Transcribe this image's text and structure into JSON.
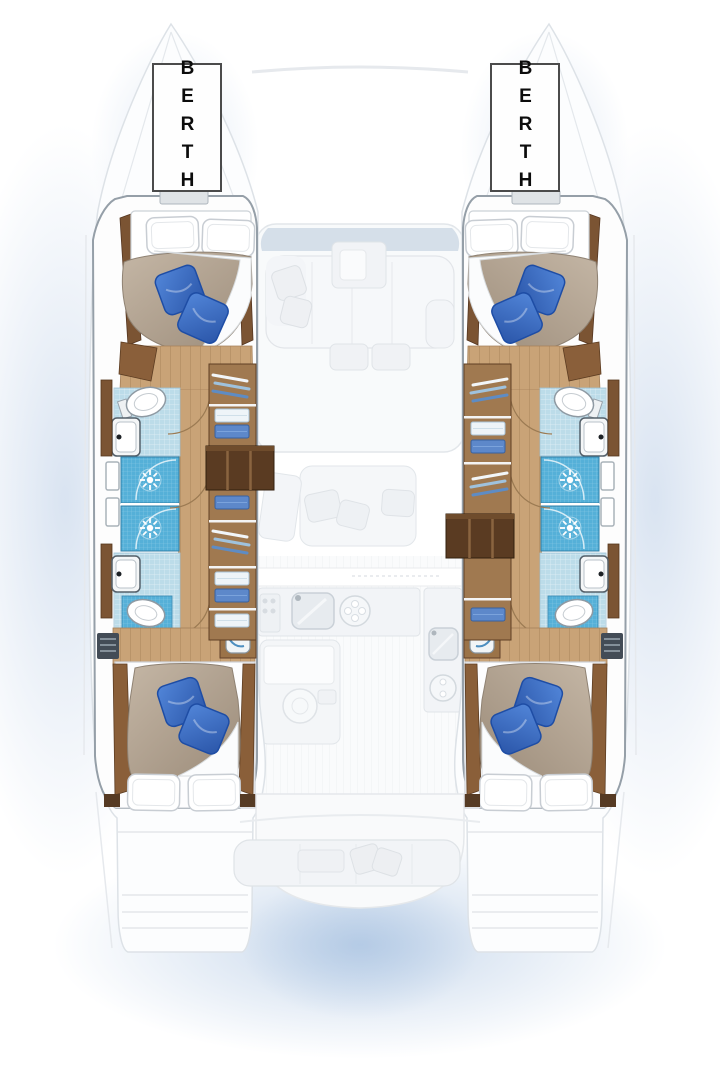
{
  "labels": {
    "berth_port": "BERTH",
    "berth_starboard": "BERTH"
  },
  "floorplan": {
    "type": "catamaran-interior-deck-plan",
    "highlighted_areas": [
      "port-forward-berth",
      "starboard-forward-berth",
      "port-aft-berth",
      "starboard-aft-berth",
      "port-heads-with-shower-stalls",
      "starboard-heads-with-shower-stalls",
      "wardrobe-shelving",
      "companionway-steps",
      "vanity-sinks",
      "toilets"
    ],
    "ghosted_areas": [
      "saloon",
      "galley",
      "cockpit",
      "swim-platforms",
      "foredeck",
      "bows"
    ]
  },
  "colors": {
    "background": "#ffffff",
    "water_glow": "#bccfe8",
    "hull_outline": "#959fa8",
    "ghost_fill": "#f8fafb",
    "ghost_stroke": "#e2e6ea",
    "wood_floor": "#c9a377",
    "wood_trim": "#7b5433",
    "steps_wood": "#5a3b22",
    "tile_blue": "#bcdce9",
    "shower_blue": "#55b0d8",
    "pillow_blue": "#3b6fc6",
    "duvet_tan": "#b0a190",
    "label_border": "#4b4b4b"
  }
}
